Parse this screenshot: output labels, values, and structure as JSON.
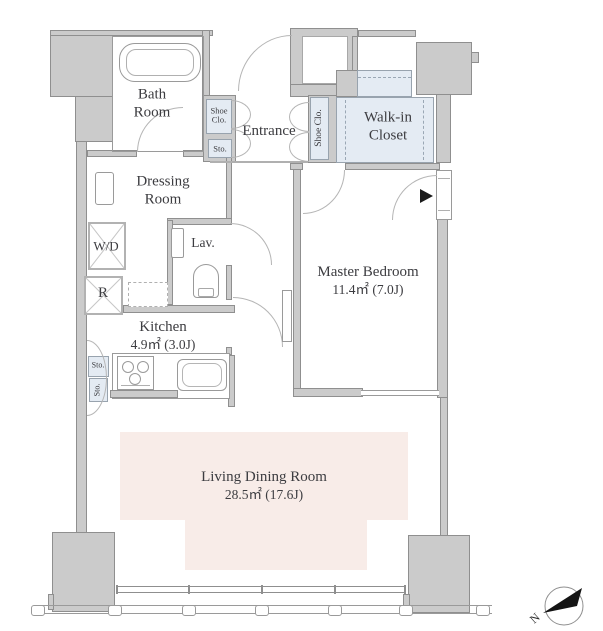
{
  "title": "apartment-floor-plan",
  "rooms": {
    "bath": {
      "label": "Bath Room"
    },
    "entrance": {
      "label": "Entrance"
    },
    "walk_in_closet": {
      "label": "Walk-in Closet"
    },
    "dressing": {
      "label": "Dressing Room"
    },
    "washer_dryer": {
      "label": "W/D"
    },
    "lavatory": {
      "label": "Lav."
    },
    "refrigerator": {
      "label": "R"
    },
    "kitchen": {
      "label": "Kitchen",
      "area": "4.9㎡ (3.0J)"
    },
    "master_bedroom": {
      "label": "Master Bedroom",
      "area": "11.4㎡ (7.0J)"
    },
    "living_dining": {
      "label": "Living Dining Room",
      "area": "28.5㎡ (17.6J)"
    }
  },
  "storage": {
    "shoe_closet_entrance_left": "Shoe Clo.",
    "shoe_closet_entrance_right": "Shoe Clo.",
    "entrance_storage": "Sto.",
    "kitchen_storage_upper": "Sto.",
    "kitchen_storage_lower": "Sto."
  },
  "compass": {
    "label": "N"
  },
  "colors": {
    "wall_fill": "#cbcbcb",
    "wall_line": "#8f8f8f",
    "closet_fill": "#e4ebf3",
    "living_fill": "#f8ece8",
    "text": "#3c3c40",
    "door_arc": "#b5b5b5",
    "arrow_black": "#141414"
  }
}
